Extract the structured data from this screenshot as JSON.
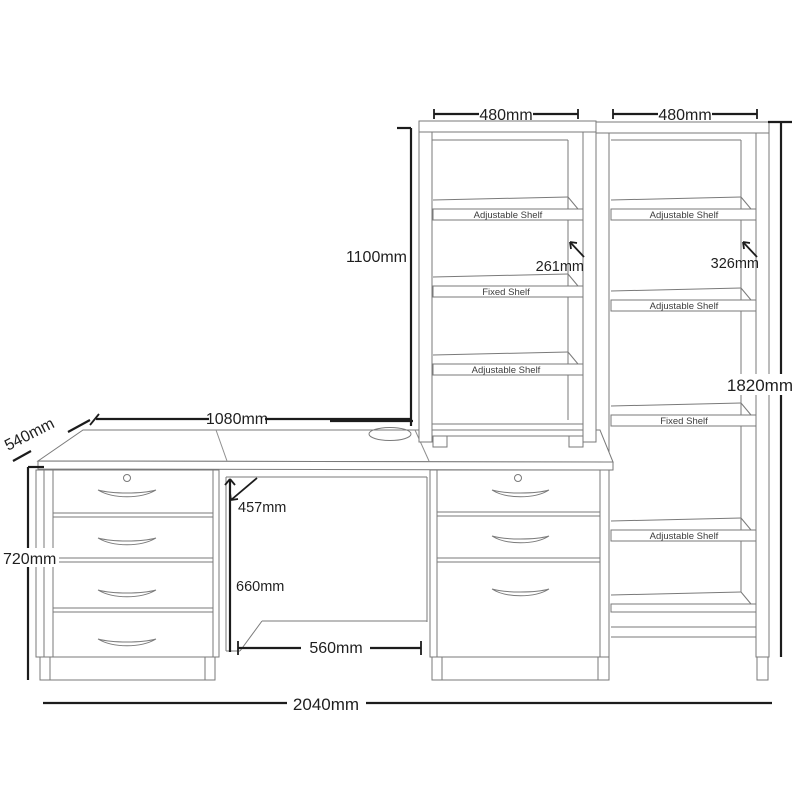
{
  "diagram": {
    "title": "Desk with drawer pedestals and bookcases - dimension diagram",
    "units": "mm",
    "labels": {
      "adjustable_shelf": "Adjustable Shelf",
      "fixed_shelf": "Fixed Shelf"
    },
    "dimensions": {
      "overall_width": "2040mm",
      "desk_width": "1080mm",
      "desk_depth": "540mm",
      "desk_height": "720mm",
      "left_bookcase_width": "480mm",
      "right_bookcase_width": "480mm",
      "left_bookcase_height": "1100mm",
      "right_bookcase_height": "1820mm",
      "left_bookcase_shelf_depth": "261mm",
      "right_bookcase_shelf_depth": "326mm",
      "kneehole_top_depth": "457mm",
      "kneehole_height": "660mm",
      "kneehole_width": "560mm"
    },
    "colors": {
      "background": "#ffffff",
      "furniture_line": "#7a7a7a",
      "dimension_line": "#1c1c1c",
      "text": "#1f1f1f"
    }
  }
}
